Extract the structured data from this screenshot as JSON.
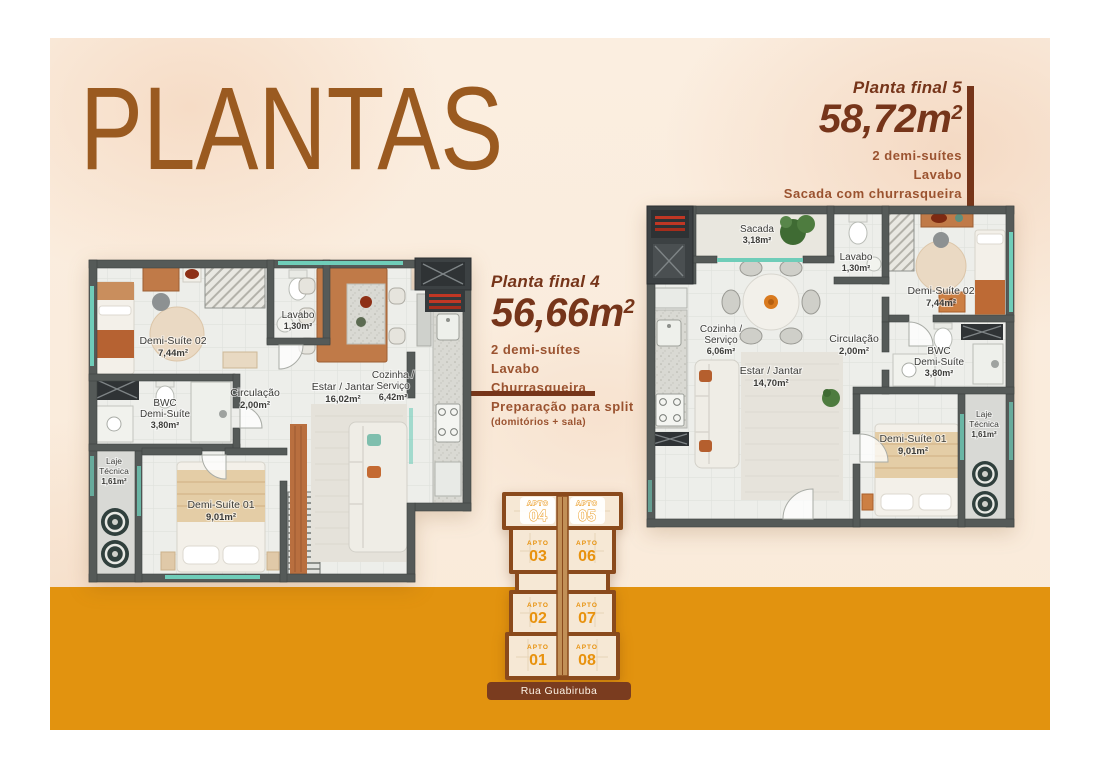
{
  "page": {
    "title": "PLANTAS"
  },
  "colors": {
    "title_brown": "#9A5A20",
    "heading_brown": "#76351A",
    "feature_rust": "#9B5330",
    "orange_band": "#E2930F",
    "apto_orange": "#E8920E",
    "banner_brown": "#7A3C1F",
    "keyplan_outline": "#8A4A1C",
    "wall_gray": "#555A58",
    "window_teal": "#6FCDB9"
  },
  "plan4": {
    "heading": "Planta final 4",
    "size": "56,66m",
    "size_sup": "2",
    "features": [
      "2 demi-suítes",
      "Lavabo",
      "Churrasqueira",
      "Preparação para split"
    ],
    "note": "(domitórios + sala)",
    "rooms": {
      "demi2": {
        "name": [
          "Demi-Suíte 02"
        ],
        "area": "7,44m²"
      },
      "lavabo": {
        "name": [
          "Lavabo"
        ],
        "area": "1,30m²"
      },
      "circ": {
        "name": [
          "Circulação"
        ],
        "area": "2,00m²"
      },
      "bwc": {
        "name": [
          "BWC",
          "Demi-Suíte"
        ],
        "area": "3,80m²"
      },
      "laje": {
        "name": [
          "Laje",
          "Técnica"
        ],
        "area": "1,61m²"
      },
      "demi1": {
        "name": [
          "Demi-Suíte 01"
        ],
        "area": "9,01m²"
      },
      "estar": {
        "name": [
          "Estar / Jantar"
        ],
        "area": "16,02m²"
      },
      "cozinha": {
        "name": [
          "Cozinha /",
          "Serviço"
        ],
        "area": "6,42m²"
      }
    }
  },
  "plan5": {
    "heading": "Planta final 5",
    "size": "58,72m",
    "size_sup": "2",
    "features": [
      "2 demi-suítes",
      "Lavabo",
      "Sacada com churrasqueira",
      "Preparação para split"
    ],
    "note": "(domitórios + sala)",
    "rooms": {
      "sacada": {
        "name": [
          "Sacada"
        ],
        "area": "3,18m²"
      },
      "lavabo": {
        "name": [
          "Lavabo"
        ],
        "area": "1,30m²"
      },
      "demi2": {
        "name": [
          "Demi-Suíte 02"
        ],
        "area": "7,44m²"
      },
      "cozinha": {
        "name": [
          "Cozinha /",
          "Serviço"
        ],
        "area": "6,06m²"
      },
      "circ": {
        "name": [
          "Circulação"
        ],
        "area": "2,00m²"
      },
      "bwc": {
        "name": [
          "BWC",
          "Demi-Suíte"
        ],
        "area": "3,80m²"
      },
      "estar": {
        "name": [
          "Estar / Jantar"
        ],
        "area": "14,70m²"
      },
      "demi1": {
        "name": [
          "Demi-Suíte 01"
        ],
        "area": "9,01m²"
      },
      "laje": {
        "name": [
          "Laje",
          "Técnica"
        ],
        "area": "1,61m²"
      }
    }
  },
  "keyplan": {
    "street": "Rua Guabiruba",
    "units": [
      {
        "label": "APTO",
        "num": "04",
        "highlight": true
      },
      {
        "label": "APTO",
        "num": "05",
        "highlight": true
      },
      {
        "label": "APTO",
        "num": "03",
        "highlight": false
      },
      {
        "label": "APTO",
        "num": "06",
        "highlight": false
      },
      {
        "label": "APTO",
        "num": "02",
        "highlight": false
      },
      {
        "label": "APTO",
        "num": "07",
        "highlight": false
      },
      {
        "label": "APTO",
        "num": "01",
        "highlight": false
      },
      {
        "label": "APTO",
        "num": "08",
        "highlight": false
      }
    ]
  }
}
